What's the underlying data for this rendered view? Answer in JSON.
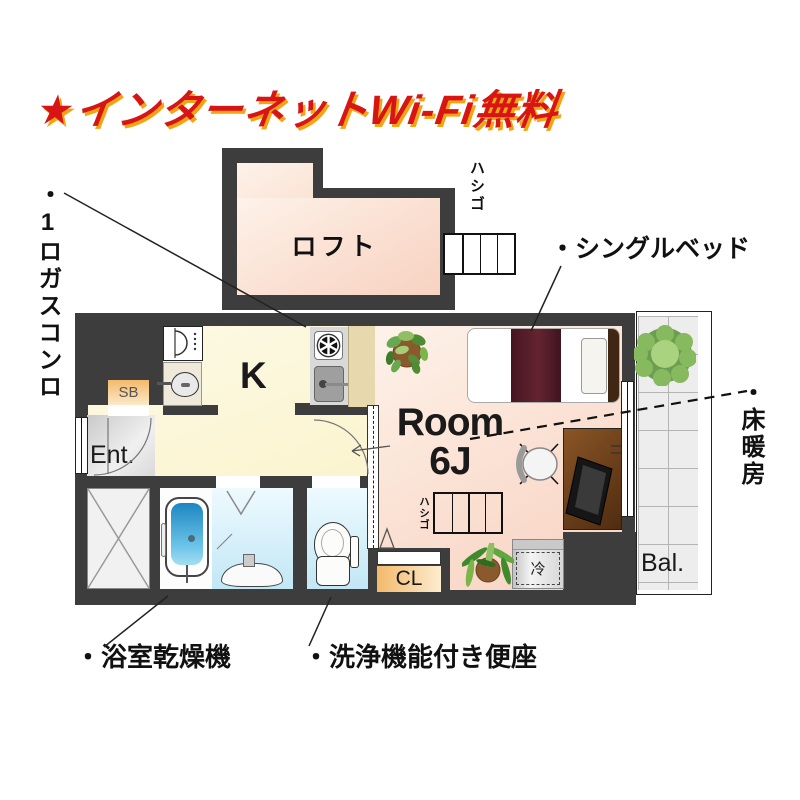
{
  "title": {
    "text": "★インターネットWi-Fi無料"
  },
  "plan": {
    "loft": {
      "label": "ロフト",
      "ladder_label": "ハシゴ"
    },
    "kitchen": {
      "label": "K"
    },
    "room": {
      "label_top": "Room",
      "label_bottom": "6J",
      "ladder_label": "ハシゴ",
      "fridge_label": "冷"
    },
    "entrance": {
      "label": "Ent.",
      "shoebox_label": "SB"
    },
    "closet_label": "CL",
    "balcony_label": "Bal."
  },
  "callouts": {
    "gas_stove": "・1ロガスコンロ",
    "single_bed": "・シングルベッド",
    "floor_heating": "・床暖房",
    "bathroom_dryer": "・浴室乾燥機",
    "washlet": "・洗浄機能付き便座"
  },
  "colors": {
    "wall": "#3d3d3d",
    "loft_room_floor": "#f9ddcf",
    "kitchen_floor": "#fcf6d8",
    "bathroom_floor": "#cfeaf7",
    "entrance_floor": "#d6d6d6",
    "balcony_tile": "#ededed",
    "storage_orange": "#f5c17c",
    "title_red": "#d81414",
    "title_shadow_yellow": "#f2a413",
    "bed_blanket": "#4f1b26",
    "desk_brown": "#6f4018",
    "tub_blue": "#2b97cc",
    "plant_green": "#6aa84f"
  }
}
